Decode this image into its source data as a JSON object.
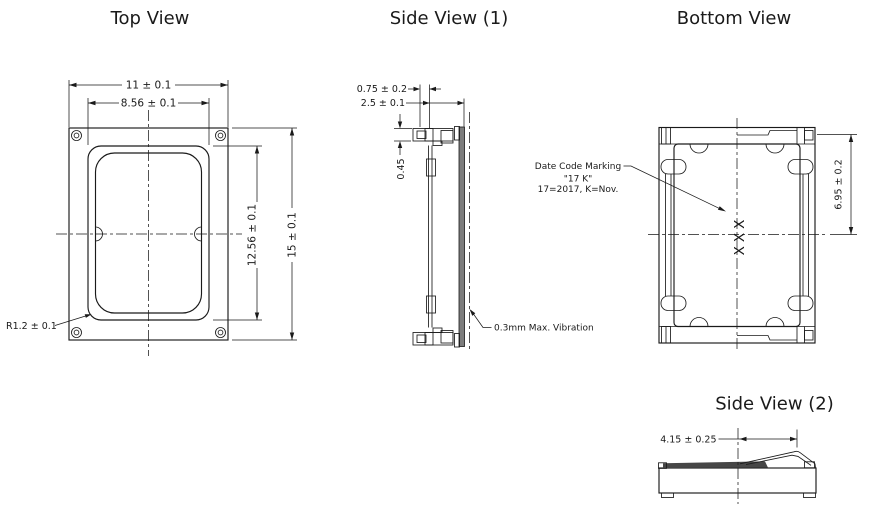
{
  "meta": {
    "background": "#ffffff",
    "line_color": "#1a1a1a",
    "text_color": "#1a1a1a",
    "gray_fill": "#7d7d7d"
  },
  "views": {
    "top_view": {
      "title": "Top View",
      "dim_outer_width": "11 ± 0.1",
      "dim_inner_width": "8.56 ± 0.1",
      "dim_inner_height": "12.56 ± 0.1",
      "dim_outer_height": "15 ± 0.1",
      "label_corner_radius": "R1.2 ± 0.1"
    },
    "side_view_1": {
      "title": "Side View (1)",
      "dim_terminal_protrusion": "0.75 ± 0.2",
      "dim_depth": "2.5 ± 0.1",
      "dim_terminal_thickness": "0.45",
      "note_vibration": "0.3mm Max. Vibration"
    },
    "bottom_view": {
      "title": "Bottom View",
      "dim_center_to_edge": "6.95 ± 0.2",
      "date_code_line1": "Date Code Marking",
      "date_code_line2": "\"17 K\"",
      "date_code_line3": "17=2017, K=Nov.",
      "marking_text": "XXX"
    },
    "side_view_2": {
      "title": "Side View (2)",
      "dim_contact_offset": "4.15 ± 0.25"
    }
  }
}
